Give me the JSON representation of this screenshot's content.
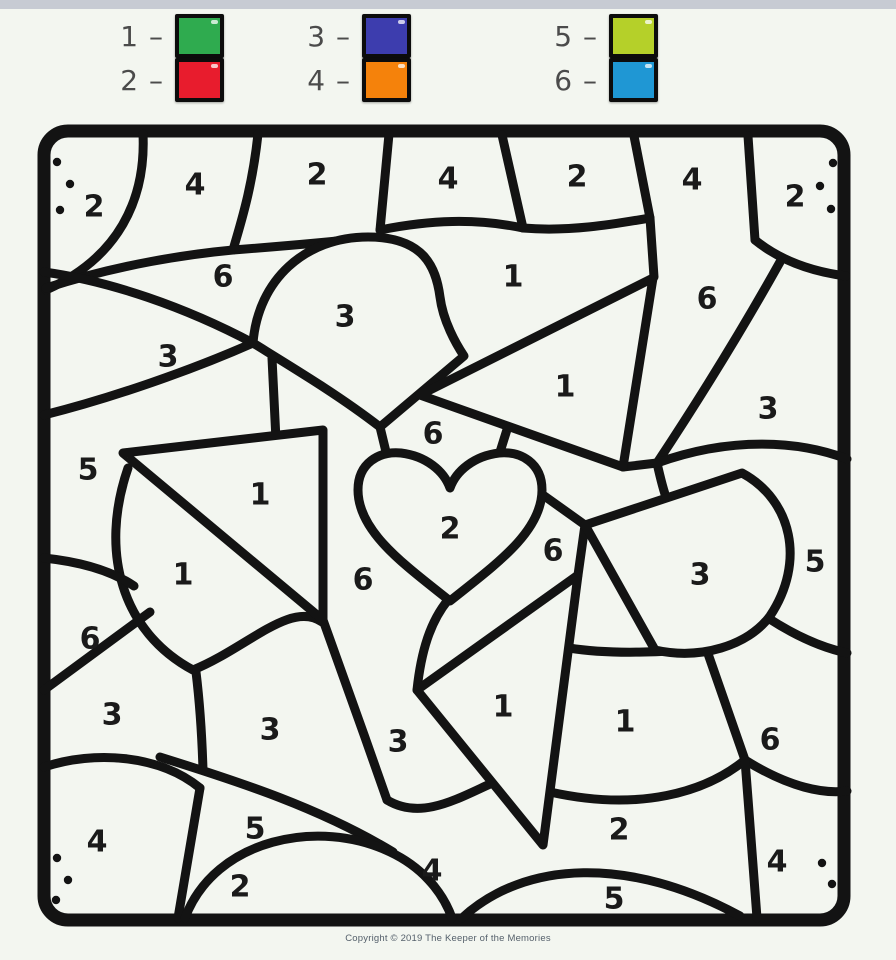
{
  "page": {
    "background": "#f3f6f0",
    "top_bar_color": "#c7cbd3"
  },
  "legend": {
    "items": [
      {
        "label": "1 –",
        "number": "1",
        "color": "#2fab4f"
      },
      {
        "label": "2 –",
        "number": "2",
        "color": "#e81c2d"
      },
      {
        "label": "3 –",
        "number": "3",
        "color": "#3d3dae"
      },
      {
        "label": "4 –",
        "number": "4",
        "color": "#f5820b"
      },
      {
        "label": "5 –",
        "number": "5",
        "color": "#b5d029"
      },
      {
        "label": "6 –",
        "number": "6",
        "color": "#1f97d4"
      }
    ]
  },
  "worksheet": {
    "line_color": "#131313",
    "region_labels": [
      {
        "n": "2",
        "x": 94,
        "y": 207
      },
      {
        "n": "4",
        "x": 195,
        "y": 185
      },
      {
        "n": "2",
        "x": 317,
        "y": 175
      },
      {
        "n": "4",
        "x": 448,
        "y": 179
      },
      {
        "n": "2",
        "x": 577,
        "y": 177
      },
      {
        "n": "4",
        "x": 692,
        "y": 180
      },
      {
        "n": "2",
        "x": 795,
        "y": 197
      },
      {
        "n": "6",
        "x": 223,
        "y": 277
      },
      {
        "n": "1",
        "x": 513,
        "y": 277
      },
      {
        "n": "6",
        "x": 707,
        "y": 299
      },
      {
        "n": "3",
        "x": 345,
        "y": 317
      },
      {
        "n": "3",
        "x": 168,
        "y": 357
      },
      {
        "n": "1",
        "x": 565,
        "y": 387
      },
      {
        "n": "3",
        "x": 768,
        "y": 409
      },
      {
        "n": "5",
        "x": 88,
        "y": 470
      },
      {
        "n": "6",
        "x": 433,
        "y": 434
      },
      {
        "n": "1",
        "x": 260,
        "y": 495
      },
      {
        "n": "2",
        "x": 450,
        "y": 529
      },
      {
        "n": "6",
        "x": 553,
        "y": 551
      },
      {
        "n": "3",
        "x": 700,
        "y": 575
      },
      {
        "n": "5",
        "x": 815,
        "y": 562
      },
      {
        "n": "1",
        "x": 183,
        "y": 575
      },
      {
        "n": "6",
        "x": 363,
        "y": 580
      },
      {
        "n": "6",
        "x": 90,
        "y": 639
      },
      {
        "n": "3",
        "x": 112,
        "y": 715
      },
      {
        "n": "3",
        "x": 270,
        "y": 730
      },
      {
        "n": "3",
        "x": 398,
        "y": 742
      },
      {
        "n": "1",
        "x": 503,
        "y": 707
      },
      {
        "n": "1",
        "x": 625,
        "y": 722
      },
      {
        "n": "6",
        "x": 770,
        "y": 740
      },
      {
        "n": "4",
        "x": 97,
        "y": 842
      },
      {
        "n": "5",
        "x": 255,
        "y": 829
      },
      {
        "n": "2",
        "x": 619,
        "y": 830
      },
      {
        "n": "4",
        "x": 777,
        "y": 862
      },
      {
        "n": "2",
        "x": 240,
        "y": 887
      },
      {
        "n": "4",
        "x": 432,
        "y": 871
      },
      {
        "n": "5",
        "x": 614,
        "y": 899
      }
    ],
    "corner_dots": [
      [
        57,
        162
      ],
      [
        70,
        184
      ],
      [
        60,
        210
      ],
      [
        833,
        163
      ],
      [
        820,
        186
      ],
      [
        831,
        209
      ],
      [
        57,
        858
      ],
      [
        68,
        880
      ],
      [
        56,
        900
      ],
      [
        822,
        863
      ],
      [
        832,
        884
      ]
    ]
  },
  "footer": {
    "copyright": "Copyright © 2019 The Keeper of the Memories"
  }
}
